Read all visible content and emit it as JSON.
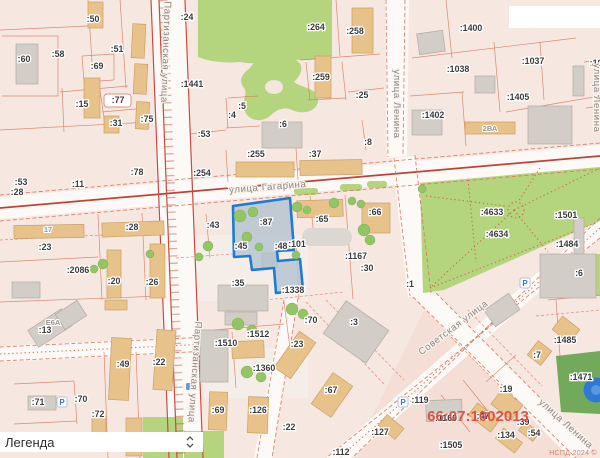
{
  "app": {
    "watermark": "НСПД 2024 ©"
  },
  "legend": {
    "title": "Легенда"
  },
  "map": {
    "colors": {
      "selection_border": "#1f7ad4",
      "selection_fill": "#b2c2cf",
      "quarter_text": "#e04a3d",
      "park_green": "#b4d47e",
      "building_tan": "#e7c38b",
      "road_red": "#bd4338",
      "parking_blue": "#3b77c2"
    },
    "selected_parcel": {
      "id": ":87"
    },
    "quarter_label": {
      "text": "66:07:1002013",
      "x": 478,
      "y": 421
    },
    "street_labels": [
      {
        "text": "улица Гагарина",
        "x": 268,
        "y": 190,
        "rot": -4.5
      },
      {
        "text": "Партизанская улица",
        "x": 163,
        "y": 52,
        "rot": 92
      },
      {
        "text": "Партизанская улица",
        "x": 192,
        "y": 372,
        "rot": 94
      },
      {
        "text": "улица Ленина",
        "x": 394,
        "y": 104,
        "rot": 90
      },
      {
        "text": "улица Ленина",
        "x": 594,
        "y": 98,
        "rot": 90
      },
      {
        "text": "Советская улица",
        "x": 455,
        "y": 330,
        "rot": -37
      },
      {
        "text": "улица Ленина",
        "x": 564,
        "y": 426,
        "rot": 42
      }
    ],
    "parcel_labels": [
      {
        "text": ":50",
        "x": 93,
        "y": 22
      },
      {
        "text": ":60",
        "x": 24,
        "y": 62
      },
      {
        "text": ":58",
        "x": 58,
        "y": 57
      },
      {
        "text": ":69",
        "x": 97,
        "y": 69
      },
      {
        "text": ":51",
        "x": 117,
        "y": 52
      },
      {
        "text": ":24",
        "x": 187,
        "y": 20
      },
      {
        "text": ":1441",
        "x": 192,
        "y": 87
      },
      {
        "text": ":15",
        "x": 82,
        "y": 107
      },
      {
        "text": ":77",
        "x": 118,
        "y": 103
      },
      {
        "text": ":31",
        "x": 116,
        "y": 126
      },
      {
        "text": ":75",
        "x": 147,
        "y": 122
      },
      {
        "text": ":264",
        "x": 316,
        "y": 30
      },
      {
        "text": ":258",
        "x": 355,
        "y": 34
      },
      {
        "text": ":259",
        "x": 321,
        "y": 80
      },
      {
        "text": ":25",
        "x": 362,
        "y": 98
      },
      {
        "text": ":5",
        "x": 242,
        "y": 109
      },
      {
        "text": ":4",
        "x": 232,
        "y": 118
      },
      {
        "text": ":6",
        "x": 283,
        "y": 127
      },
      {
        "text": ":53",
        "x": 204,
        "y": 137
      },
      {
        "text": ":8",
        "x": 368,
        "y": 145
      },
      {
        "text": ":1400",
        "x": 471,
        "y": 31
      },
      {
        "text": ":1038",
        "x": 458,
        "y": 72
      },
      {
        "text": ":1037",
        "x": 533,
        "y": 64
      },
      {
        "text": ":10",
        "x": 596,
        "y": 66
      },
      {
        "text": ":1405",
        "x": 518,
        "y": 100
      },
      {
        "text": ":1",
        "x": 597,
        "y": 102
      },
      {
        "text": ":1402",
        "x": 433,
        "y": 118
      },
      {
        "text": ":53",
        "x": 21,
        "y": 185
      },
      {
        "text": ":28",
        "x": 17,
        "y": 195
      },
      {
        "text": ":11",
        "x": 78,
        "y": 187
      },
      {
        "text": ":78",
        "x": 137,
        "y": 175
      },
      {
        "text": ":254",
        "x": 202,
        "y": 176
      },
      {
        "text": ":255",
        "x": 256,
        "y": 157
      },
      {
        "text": ":37",
        "x": 315,
        "y": 157
      },
      {
        "text": ":23",
        "x": 45,
        "y": 250
      },
      {
        "text": ":28",
        "x": 132,
        "y": 230
      },
      {
        "text": ":2086",
        "x": 78,
        "y": 273
      },
      {
        "text": ":20",
        "x": 114,
        "y": 284
      },
      {
        "text": ":26",
        "x": 152,
        "y": 285
      },
      {
        "text": ":43",
        "x": 213,
        "y": 228
      },
      {
        "text": ":45",
        "x": 241,
        "y": 249
      },
      {
        "text": ":87",
        "x": 266,
        "y": 225
      },
      {
        "text": ":48",
        "x": 281,
        "y": 249
      },
      {
        "text": ":101",
        "x": 297,
        "y": 247
      },
      {
        "text": ":65",
        "x": 322,
        "y": 222
      },
      {
        "text": ":66",
        "x": 375,
        "y": 215
      },
      {
        "text": ":1167",
        "x": 356,
        "y": 259
      },
      {
        "text": ":30",
        "x": 367,
        "y": 271
      },
      {
        "text": ":35",
        "x": 238,
        "y": 286
      },
      {
        "text": ":1338",
        "x": 293,
        "y": 293
      },
      {
        "text": ":4633",
        "x": 492,
        "y": 215
      },
      {
        "text": ":4634",
        "x": 497,
        "y": 237
      },
      {
        "text": ":1501",
        "x": 566,
        "y": 218
      },
      {
        "text": ":1484",
        "x": 567,
        "y": 247
      },
      {
        "text": ":1",
        "x": 410,
        "y": 287
      },
      {
        "text": ":6",
        "x": 579,
        "y": 276
      },
      {
        "text": ":13",
        "x": 45,
        "y": 333
      },
      {
        "text": ":71",
        "x": 38,
        "y": 405
      },
      {
        "text": ":70",
        "x": 81,
        "y": 402
      },
      {
        "text": ":72",
        "x": 98,
        "y": 417
      },
      {
        "text": ":49",
        "x": 123,
        "y": 367
      },
      {
        "text": ":22",
        "x": 159,
        "y": 365
      },
      {
        "text": ":1512",
        "x": 258,
        "y": 337
      },
      {
        "text": ":1510",
        "x": 226,
        "y": 346
      },
      {
        "text": ":1360",
        "x": 264,
        "y": 371
      },
      {
        "text": ":70",
        "x": 311,
        "y": 323
      },
      {
        "text": ":23",
        "x": 297,
        "y": 347
      },
      {
        "text": ":3",
        "x": 354,
        "y": 325
      },
      {
        "text": ":67",
        "x": 331,
        "y": 393
      },
      {
        "text": ":69",
        "x": 218,
        "y": 413
      },
      {
        "text": ":126",
        "x": 258,
        "y": 413
      },
      {
        "text": ":22",
        "x": 289,
        "y": 430
      },
      {
        "text": ":127",
        "x": 380,
        "y": 435
      },
      {
        "text": ":112",
        "x": 341,
        "y": 455
      },
      {
        "text": ":119",
        "x": 420,
        "y": 403
      },
      {
        "text": ":1160",
        "x": 446,
        "y": 421
      },
      {
        "text": ":47",
        "x": 483,
        "y": 419
      },
      {
        "text": ":19",
        "x": 506,
        "y": 392
      },
      {
        "text": ":39",
        "x": 523,
        "y": 425
      },
      {
        "text": ":54",
        "x": 534,
        "y": 436
      },
      {
        "text": ":134",
        "x": 506,
        "y": 438
      },
      {
        "text": ":1505",
        "x": 451,
        "y": 448
      },
      {
        "text": ":7",
        "x": 537,
        "y": 358
      },
      {
        "text": ":1485",
        "x": 565,
        "y": 343
      },
      {
        "text": ":1471",
        "x": 581,
        "y": 380
      }
    ],
    "building_labels": [
      {
        "text": "2ВА",
        "x": 490,
        "y": 131
      },
      {
        "text": "Е6А",
        "x": 53,
        "y": 325
      },
      {
        "text": "17",
        "x": 48,
        "y": 232
      }
    ],
    "poi": {
      "parking_letter": "Р",
      "parking_icons": [
        {
          "x": 403,
          "y": 402
        },
        {
          "x": 525,
          "y": 283
        },
        {
          "x": 62,
          "y": 402
        }
      ]
    }
  }
}
